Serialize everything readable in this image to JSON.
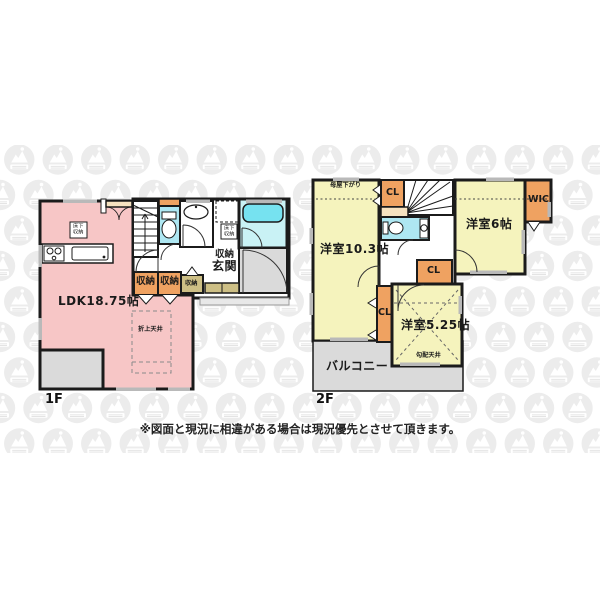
{
  "document": {
    "type": "floorplan",
    "disclaimer": "※図面と現況に相違がある場合は現況優先とさせて頂きます。"
  },
  "palette": {
    "ldk_pink": "#f7c6c6",
    "bedroom_yellow": "#f5f3bd",
    "closet_orange": "#efa261",
    "wet_area_cyan": "#aee7f2",
    "bath_cyan": "#c9f2f5",
    "tub_cyan": "#76e2f0",
    "balcony_gray": "#dadada",
    "step_tan": "#cdbf85",
    "pantry_cream": "#f6e2c0",
    "wall_black": "#1b1b1b",
    "watermark_gray": "#ececec"
  },
  "floor1": {
    "label": "1F",
    "rooms": {
      "ldk": "LDK18.75帖",
      "genkan": "玄関",
      "genkan_storage": "収納",
      "storage_a": "収納",
      "storage_b": "収納",
      "storage_c": "収納",
      "ceiling_note": "折上天井",
      "floor_storage": "床下収納",
      "wash_floor_storage": "床下収納"
    }
  },
  "floor2": {
    "label": "2F",
    "rooms": {
      "bedroom_103": "洋室10.3帖",
      "bedroom_6": "洋室6帖",
      "bedroom_525": "洋室5.25帖",
      "balcony": "バルコニー",
      "wic": "WIC",
      "cl_top": "CL",
      "cl_mid": "CL",
      "cl_side": "CL",
      "moya_sagari": "母屋下がり",
      "sloped_ceiling": "勾配天井"
    }
  }
}
